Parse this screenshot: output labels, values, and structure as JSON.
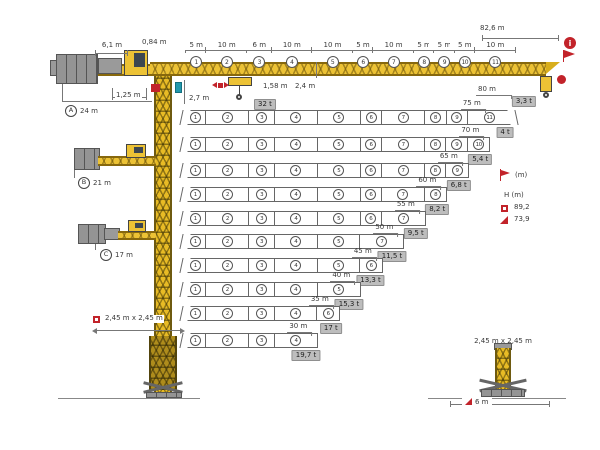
{
  "top_crane": {
    "overall_length": "82,6 m",
    "jib_length": "80 m",
    "tip_load": "3,3 t",
    "max_capacity": "32 t",
    "pivot_offset": "0,84 m",
    "ballast_width": "6,1 m",
    "counterjib_depth": "1,25 m",
    "jib_foot_height": "2,7 m",
    "hook_drop": "1,58 m",
    "jib_section_height": "2,4 m",
    "segments": [
      {
        "num": "1",
        "len": "5 m"
      },
      {
        "num": "2",
        "len": "10 m"
      },
      {
        "num": "3",
        "len": "6 m"
      },
      {
        "num": "4",
        "len": "10 m"
      },
      {
        "num": "5",
        "len": "10 m"
      },
      {
        "num": "6",
        "len": "5 m"
      },
      {
        "num": "7",
        "len": "10 m"
      },
      {
        "num": "8",
        "len": "5 m"
      },
      {
        "num": "9",
        "len": "5 m"
      },
      {
        "num": "10",
        "len": "5 m"
      },
      {
        "num": "11",
        "len": "10 m"
      }
    ]
  },
  "counterjib_options": [
    {
      "letter": "A",
      "radius": "24 m"
    },
    {
      "letter": "B",
      "radius": "21 m"
    },
    {
      "letter": "C",
      "radius": "17 m"
    }
  ],
  "jib_rows": [
    {
      "label": "75 m",
      "m": 75,
      "sections": [
        1,
        2,
        3,
        4,
        5,
        6,
        7,
        8,
        9,
        11
      ],
      "tip_load": "4 t"
    },
    {
      "label": "70 m",
      "m": 70,
      "sections": [
        1,
        2,
        3,
        4,
        5,
        6,
        7,
        8,
        9,
        10
      ],
      "tip_load": "5,4 t"
    },
    {
      "label": "65 m",
      "m": 65,
      "sections": [
        1,
        2,
        3,
        4,
        5,
        6,
        7,
        8,
        9
      ],
      "tip_load": "6,8 t"
    },
    {
      "label": "60 m",
      "m": 60,
      "sections": [
        1,
        2,
        3,
        4,
        5,
        6,
        7,
        8
      ],
      "tip_load": "8,2 t"
    },
    {
      "label": "55 m",
      "m": 55,
      "sections": [
        1,
        2,
        3,
        4,
        5,
        6,
        7
      ],
      "tip_load": "9,5 t"
    },
    {
      "label": "50 m",
      "m": 50,
      "sections": [
        1,
        2,
        3,
        4,
        5,
        7
      ],
      "tip_load": "11,5 t"
    },
    {
      "label": "45 m",
      "m": 45,
      "sections": [
        1,
        2,
        3,
        4,
        5,
        6
      ],
      "tip_load": "13,3 t"
    },
    {
      "label": "40 m",
      "m": 40,
      "sections": [
        1,
        2,
        3,
        4,
        5
      ],
      "tip_load": "15,3 t"
    },
    {
      "label": "35 m",
      "m": 35,
      "sections": [
        1,
        2,
        3,
        4,
        6
      ],
      "tip_load": "17 t"
    },
    {
      "label": "30 m",
      "m": 30,
      "sections": [
        1,
        2,
        3,
        4
      ],
      "tip_load": "19,7 t"
    }
  ],
  "legend": {
    "radius_unit": "(m)",
    "height_label": "H (m)",
    "entries": [
      {
        "icon": "fixed-base-icon",
        "value": "89,2"
      },
      {
        "icon": "chassis-base-icon",
        "value": "73,9"
      }
    ]
  },
  "bases": {
    "mast_cross_section_left": "2,45 m x 2,45 m",
    "mast_cross_section_right": "2,45 m x 2,45 m",
    "chassis_width": "6 m"
  }
}
